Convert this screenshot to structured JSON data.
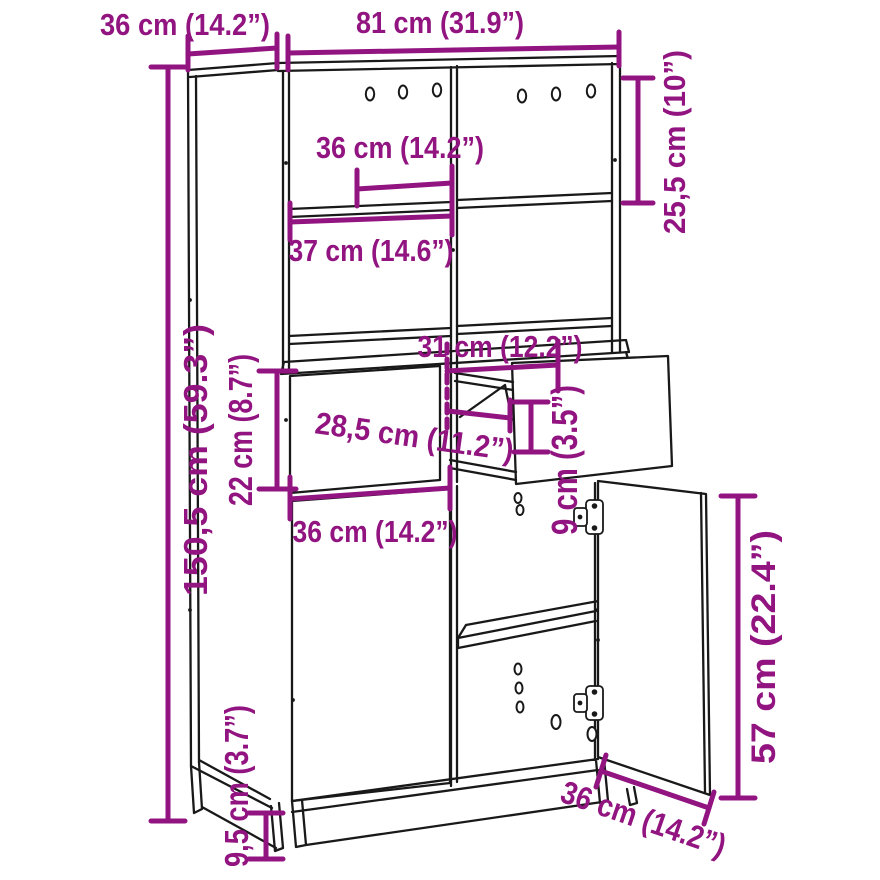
{
  "diagram": {
    "subject": "highboard-cabinet-dimension-drawing",
    "background_color": "#ffffff",
    "line_color": "#191919",
    "dimension_color": "#911480",
    "dimensions": {
      "top_depth": "36 cm (14.2”)",
      "total_width": "81 cm (31.9”)",
      "top_compartment_height": "25,5 cm (10”)",
      "upper_compartment_width": "36 cm (14.2”)",
      "middle_shelf_width": "37 cm (14.6”)",
      "drawer_opening_width": "31 cm (12.2”)",
      "drawer_inner_depth": "28,5 cm (11.2”)",
      "drawer_front_height": "22 cm (8.7”)",
      "drawer_opening_height": "9 cm (3.5”)",
      "drawer_width": "36 cm (14.2”)",
      "total_height": "150,5 cm (59.3”)",
      "base_height": "9,5 cm (3.7”)",
      "door_height": "57 cm (22.4”)",
      "door_width": "36 cm (14.2”)"
    }
  }
}
